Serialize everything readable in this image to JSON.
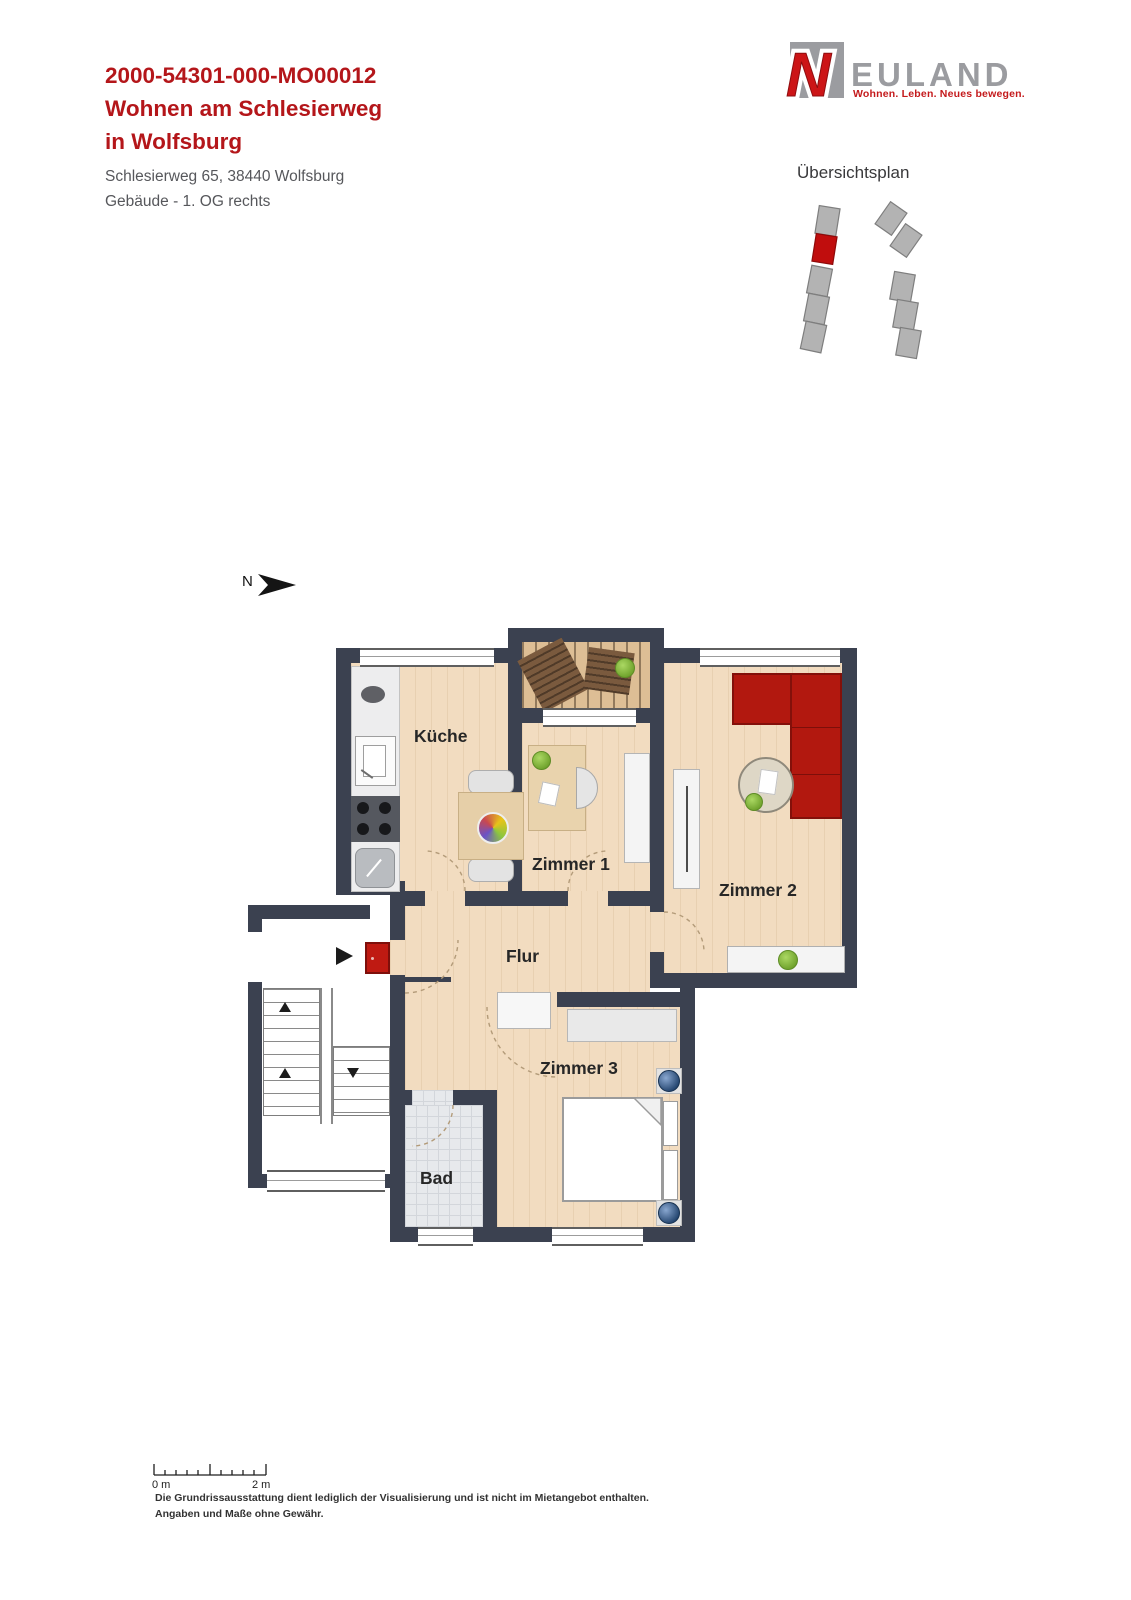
{
  "header": {
    "code": "2000-54301-000-MO00012",
    "title_line1": "Wohnen am Schlesierweg",
    "title_line2": "in Wolfsburg",
    "address": "Schlesierweg 65, 38440 Wolfsburg",
    "unit_info": "Gebäude - 1. OG rechts"
  },
  "logo": {
    "letter": "N",
    "wordmark": "EULAND",
    "tagline": "Wohnen. Leben. Neues bewegen."
  },
  "overview_plan": {
    "title": "Übersichtsplan"
  },
  "floorplan": {
    "north_label": "N",
    "rooms": {
      "kueche": "Küche",
      "zimmer1": "Zimmer 1",
      "zimmer2": "Zimmer 2",
      "zimmer3": "Zimmer 3",
      "flur": "Flur",
      "bad": "Bad"
    }
  },
  "scale_bar": {
    "start_label": "0 m",
    "end_label": "2 m"
  },
  "disclaimer": {
    "line1": "Die Grundrissausstattung dient lediglich der Visualisierung und ist nicht im Mietangebot enthalten.",
    "line2": "Angaben und Maße ohne Gewähr."
  },
  "colors": {
    "accent_red": "#b4161a",
    "wall": "#3b4150",
    "floor_wood": "#f2dcc0",
    "balcony_deck": "#ddbe95",
    "tile": "#e7e9ec",
    "logo_gray": "#9b9ca0",
    "logo_red": "#cc1517",
    "site_block_gray": "#b3b3b3",
    "site_block_highlight": "#c00d0d",
    "sofa_red": "#b2180f",
    "entry_door_red": "#bf1a12",
    "plant_green": "#8cc63f"
  }
}
